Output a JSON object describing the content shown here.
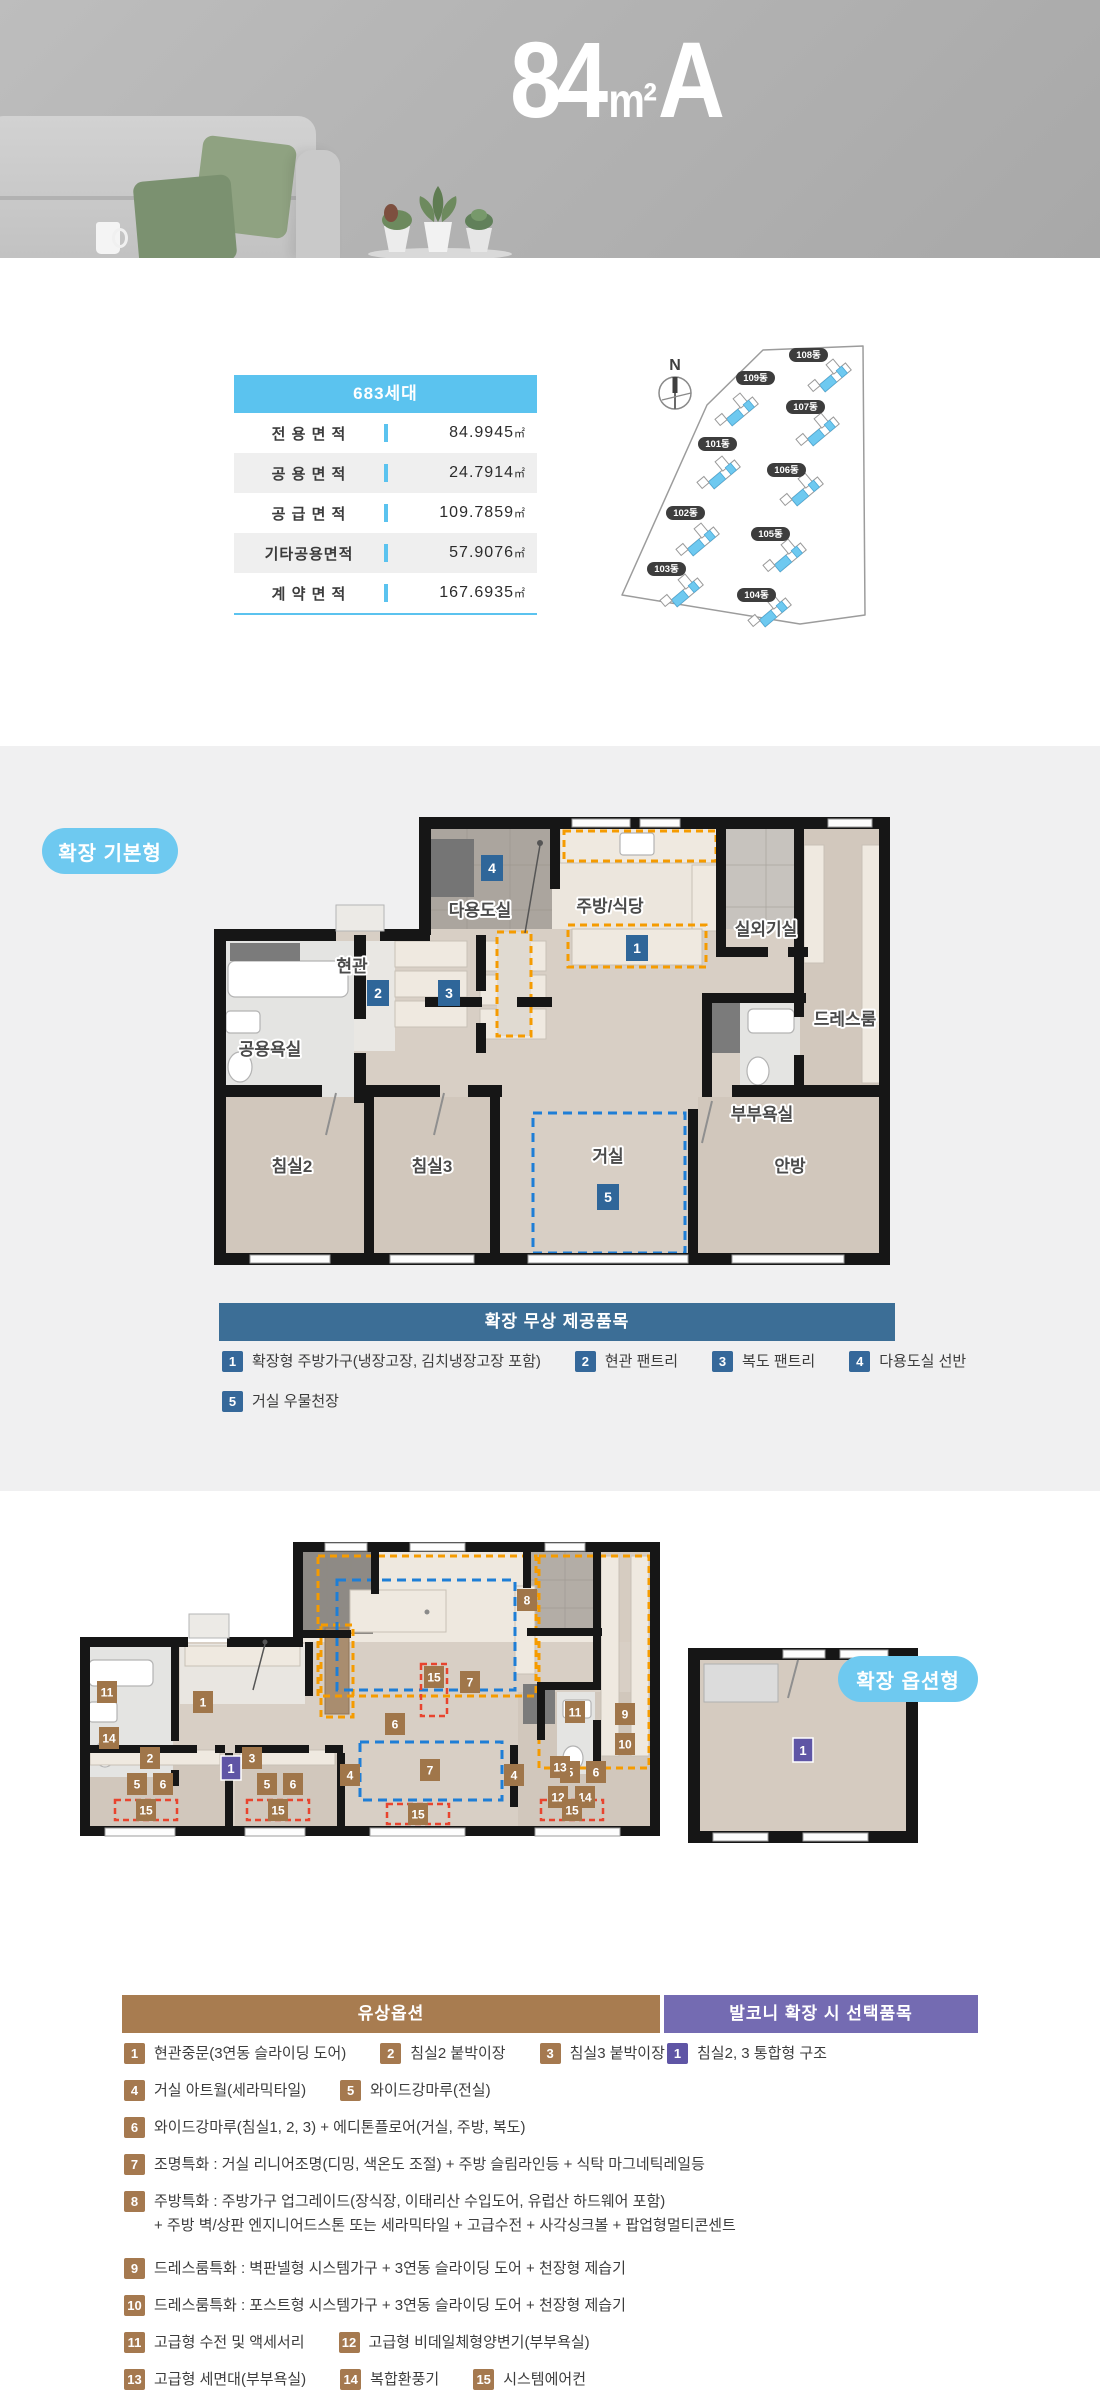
{
  "hero": {
    "num": "84",
    "unit": "m²",
    "type": "A"
  },
  "area_table": {
    "header": "683세대",
    "rows": [
      {
        "label": "전 용 면 적",
        "value": "84.9945",
        "unit": "㎡"
      },
      {
        "label": "공 용 면 적",
        "value": "24.7914",
        "unit": "㎡"
      },
      {
        "label": "공 급 면 적",
        "value": "109.7859",
        "unit": "㎡"
      },
      {
        "label": "기타공용면적",
        "value": "57.9076",
        "unit": "㎡"
      },
      {
        "label": "계 약 면 적",
        "value": "167.6935",
        "unit": "㎡"
      }
    ]
  },
  "site_plan": {
    "compass": "N",
    "buildings": [
      "108동",
      "109동",
      "107동",
      "101동",
      "106동",
      "102동",
      "105동",
      "103동",
      "104동"
    ]
  },
  "plan_basic": {
    "badge": "확장 기본형",
    "rooms": {
      "utility": "다용도실",
      "kitchen": "주방/식당",
      "outdoor_unit": "실외기실",
      "dress": "드레스룸",
      "entrance": "현관",
      "common_bath": "공용욕실",
      "master_bath": "부부욕실",
      "bed2": "침실2",
      "bed3": "침실3",
      "living": "거실",
      "master": "안방"
    }
  },
  "plan_option": {
    "badge": "확장 옵션형"
  },
  "nums": {
    "n1": "1",
    "n2": "2",
    "n3": "3",
    "n4": "4",
    "n5": "5",
    "n6": "6",
    "n7": "7",
    "n8": "8",
    "n9": "9",
    "n10": "10",
    "n11": "11",
    "n12": "12",
    "n13": "13",
    "n14": "14",
    "n15": "15"
  },
  "free_options": {
    "header": "확장 무상 제공품목",
    "items": [
      {
        "num": "1",
        "text": "확장형 주방가구(냉장고장, 김치냉장고장 포함)"
      },
      {
        "num": "2",
        "text": "현관 팬트리"
      },
      {
        "num": "3",
        "text": "복도 팬트리"
      },
      {
        "num": "4",
        "text": "다용도실 선반"
      },
      {
        "num": "5",
        "text": "거실 우물천장"
      }
    ]
  },
  "paid_options": {
    "header": "유상옵션",
    "items": [
      {
        "num": "1",
        "text": "현관중문(3연동 슬라이딩 도어)"
      },
      {
        "num": "2",
        "text": "침실2 붙박이장"
      },
      {
        "num": "3",
        "text": "침실3 붙박이장"
      },
      {
        "num": "4",
        "text": "거실 아트월(세라믹타일)"
      },
      {
        "num": "5",
        "text": "와이드강마루(전실)"
      },
      {
        "num": "6",
        "text": "와이드강마루(침실1, 2, 3) + 에디톤플로어(거실, 주방, 복도)"
      },
      {
        "num": "7",
        "text": "조명특화 : 거실 리니어조명(디밍, 색온도 조절) + 주방 슬림라인등 + 식탁 마그네틱레일등"
      },
      {
        "num": "8",
        "text": "주방특화 : 주방가구 업그레이드(장식장, 이태리산 수입도어, 유럽산 하드웨어 포함)",
        "text2": "+ 주방 벽/상판 엔지니어드스톤 또는 세라믹타일 + 고급수전 + 사각싱크볼 + 팝업형멀티콘센트"
      },
      {
        "num": "9",
        "text": "드레스룸특화 : 벽판넬형 시스템가구 + 3연동 슬라이딩 도어 + 천장형 제습기"
      },
      {
        "num": "10",
        "text": "드레스룸특화 : 포스트형 시스템가구 + 3연동 슬라이딩 도어 + 천장형 제습기"
      },
      {
        "num": "11",
        "text": "고급형 수전 및 액세서리"
      },
      {
        "num": "12",
        "text": "고급형 비데일체형양변기(부부욕실)"
      },
      {
        "num": "13",
        "text": "고급형 세면대(부부욕실)"
      },
      {
        "num": "14",
        "text": "복합환풍기"
      },
      {
        "num": "15",
        "text": "시스템에어컨"
      }
    ]
  },
  "balcony_options": {
    "header": "발코니 확장 시 선택품목",
    "items": [
      {
        "num": "1",
        "text": "침실2, 3 통합형 구조"
      }
    ]
  },
  "colors": {
    "accent_blue": "#5bc3ef",
    "pill_blue": "#6ec9f0",
    "steel_blue": "#3c6e96",
    "badge_blue": "#35689a",
    "bar_brown": "#a87c50",
    "badge_brown": "#a5794f",
    "bar_purple": "#746bb2",
    "badge_purple": "#5f55a5",
    "dash_orange": "#f59b00",
    "dash_blue": "#1e7ed6",
    "dash_red": "#e8442e"
  }
}
